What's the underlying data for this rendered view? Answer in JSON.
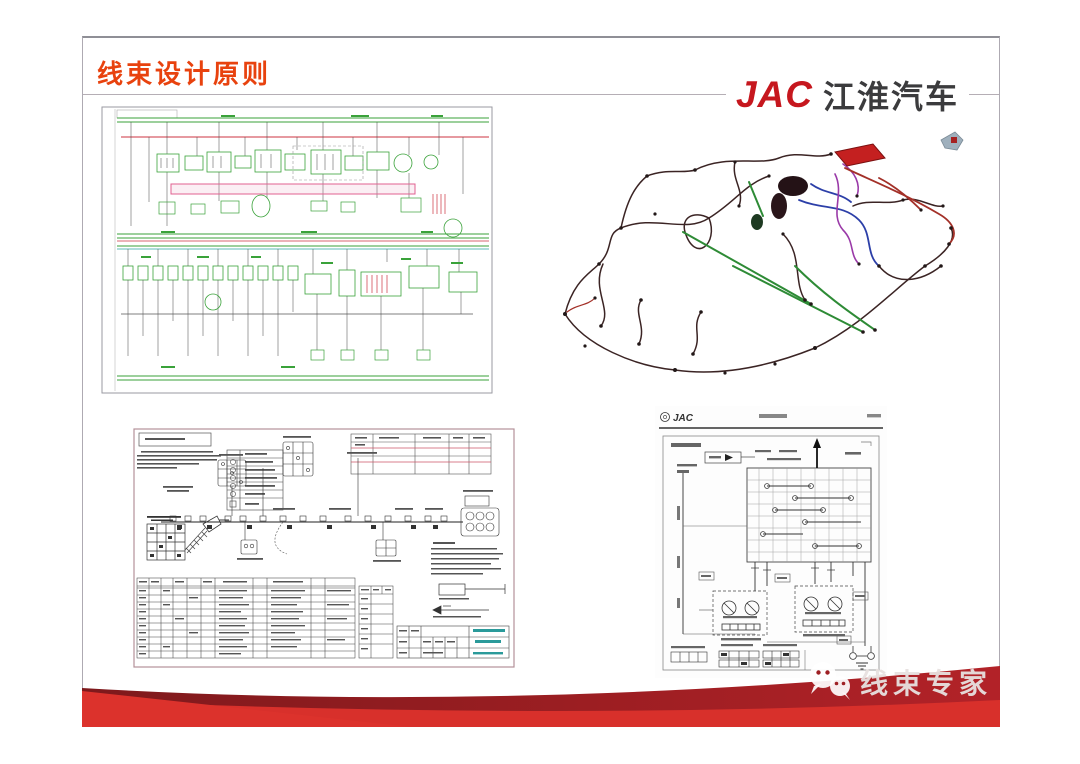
{
  "slide": {
    "title": "线束设计原则",
    "brand": {
      "latin": "JAC",
      "chinese": "江淮汽车"
    },
    "watermark": {
      "label": "线束专家",
      "icon": "wechat-icon"
    },
    "panels": {
      "circuit_schematic": {
        "description": "vehicle circuit schematic drawing"
      },
      "harness_3d": {
        "description": "3D wire harness routing view",
        "icon": "view-cube-icon"
      },
      "harness_drawing": {
        "description": "2D harness manufacturing drawing with tables"
      },
      "wiring_diagram_header": {
        "brand": "JAC"
      }
    },
    "colors": {
      "title_red": "#e8420e",
      "brand_red": "#c6171e",
      "brand_dark": "#3b3b3d",
      "ribbon_bright": "#d8302b",
      "ribbon_dark": "#8e1c20",
      "schematic_green": "#3aa23a",
      "schematic_red": "#cc3340",
      "schematic_pink": "#e06090",
      "harness_green": "#2e8b36",
      "harness_blue": "#2c3fa8",
      "harness_purple": "#9a3aa8",
      "harness_red": "#a33028",
      "titleblock_teal": "#2a9a9a"
    }
  }
}
